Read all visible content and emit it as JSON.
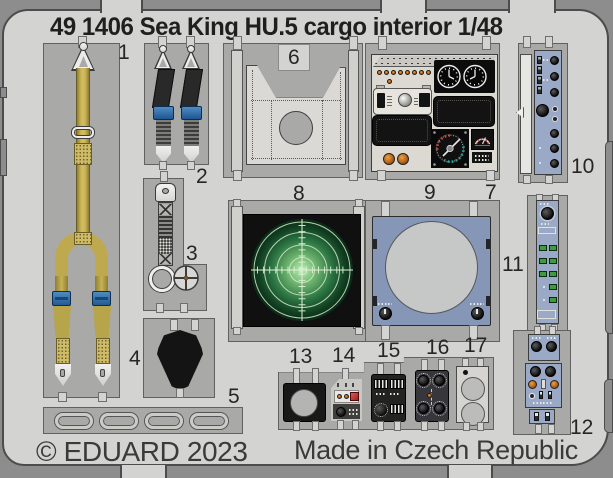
{
  "header": {
    "title": "49 1406 Sea King HU.5 cargo interior 1/48"
  },
  "footer": {
    "copyright": "© EDUARD 2023",
    "made_in": "Made in Czech Republic"
  },
  "parts": [
    {
      "number": "1",
      "name": "cargo-tiedown-strap"
    },
    {
      "number": "2",
      "name": "seatbelt-pair"
    },
    {
      "number": "3",
      "name": "strap-with-ring-and-handwheel"
    },
    {
      "number": "4",
      "name": "black-cover-plate"
    },
    {
      "number": "5",
      "name": "grab-handle-strip"
    },
    {
      "number": "6",
      "name": "bulkhead-frame-panel"
    },
    {
      "number": "7",
      "name": "instrument-panel"
    },
    {
      "number": "8",
      "name": "radar-scope-screen"
    },
    {
      "number": "9",
      "name": "radar-bezel-panel"
    },
    {
      "number": "10",
      "name": "console-side-panel"
    },
    {
      "number": "11",
      "name": "pushbutton-panel"
    },
    {
      "number": "12",
      "name": "control-box-stack"
    },
    {
      "number": "13",
      "name": "plate-with-round-hole"
    },
    {
      "number": "14",
      "name": "small-control-box"
    },
    {
      "number": "15",
      "name": "dip-switch-box"
    },
    {
      "number": "16",
      "name": "four-knob-box"
    },
    {
      "number": "17",
      "name": "twin-dial-plate"
    }
  ],
  "colors": {
    "backdrop": "#8d8d8d",
    "sheet": "#d3d3d2",
    "frame": "#a9a9a8",
    "strap_yellow": "#bfa94e",
    "buckle_blue": "#2e6cab",
    "belt_black": "#262626",
    "metal": "#ededec",
    "panel_cream": "#dbd9d1",
    "panel_black": "#151515",
    "orange": "#d07b20",
    "red": "#c43434",
    "teal": "#2e9e8e",
    "radar_bright": "#b9eeb0",
    "radar_mid": "#2a7342",
    "radar_dark": "#0a2a16",
    "panel_blue": "#8696b6",
    "panel_blue_light": "#9aa9c6",
    "button_green": "#3f9a42",
    "dial_gray": "#c6c7c7",
    "ink": "#262626"
  }
}
